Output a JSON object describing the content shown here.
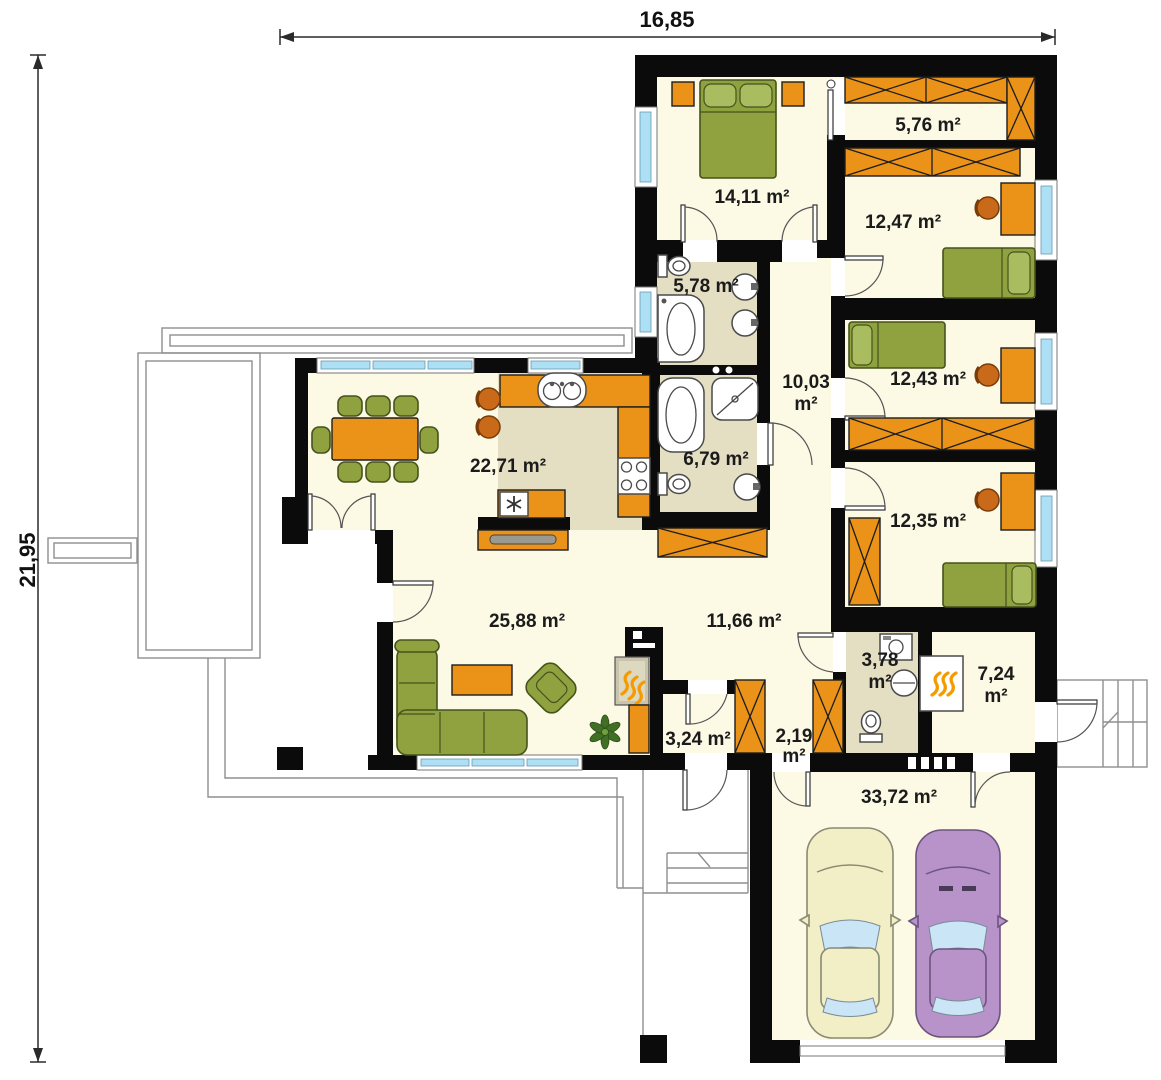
{
  "dimensions": {
    "width": "16,85",
    "height": "21,95"
  },
  "rooms": [
    {
      "id": "bedroom-1",
      "area": "14,11 m²"
    },
    {
      "id": "closet",
      "area": "5,76 m²"
    },
    {
      "id": "bedroom-2",
      "area": "12,47 m²"
    },
    {
      "id": "bathroom-1",
      "area": "5,78 m²"
    },
    {
      "id": "hallway",
      "area": "10,03",
      "area2": "m²"
    },
    {
      "id": "bedroom-3",
      "area": "12,43 m²"
    },
    {
      "id": "kitchen-dining",
      "area": "22,71 m²"
    },
    {
      "id": "bathroom-2",
      "area": "6,79 m²"
    },
    {
      "id": "bedroom-4",
      "area": "12,35 m²"
    },
    {
      "id": "living-room",
      "area": "25,88 m²"
    },
    {
      "id": "hall",
      "area": "11,66 m²"
    },
    {
      "id": "utility-wc",
      "area": "3,78",
      "area2": "m²"
    },
    {
      "id": "boiler-room",
      "area": "7,24",
      "area2": "m²"
    },
    {
      "id": "entry-hall",
      "area": "3,24 m²"
    },
    {
      "id": "vestibule",
      "area": "2,19",
      "area2": "m²"
    },
    {
      "id": "garage",
      "area": "33,72 m²"
    }
  ],
  "colors": {
    "wall": "#0b0b0b",
    "floor": "#FCF9E4",
    "tile_floor": "#E4DEC3",
    "furniture_orange": "#EB9318",
    "chair_orange": "#C96A1B",
    "furniture_green": "#8FA23F",
    "pillow_green": "#A9BC60",
    "window_glass": "#AEE0F5",
    "car_yellow": "#F2EFC6",
    "car_purple": "#B793C9",
    "glass_blue": "#C9E5F6",
    "flame": "#F59B00",
    "plant_green": "#3F7026",
    "outline_gray": "#8F8F8F",
    "text": "#1b1b1b"
  }
}
